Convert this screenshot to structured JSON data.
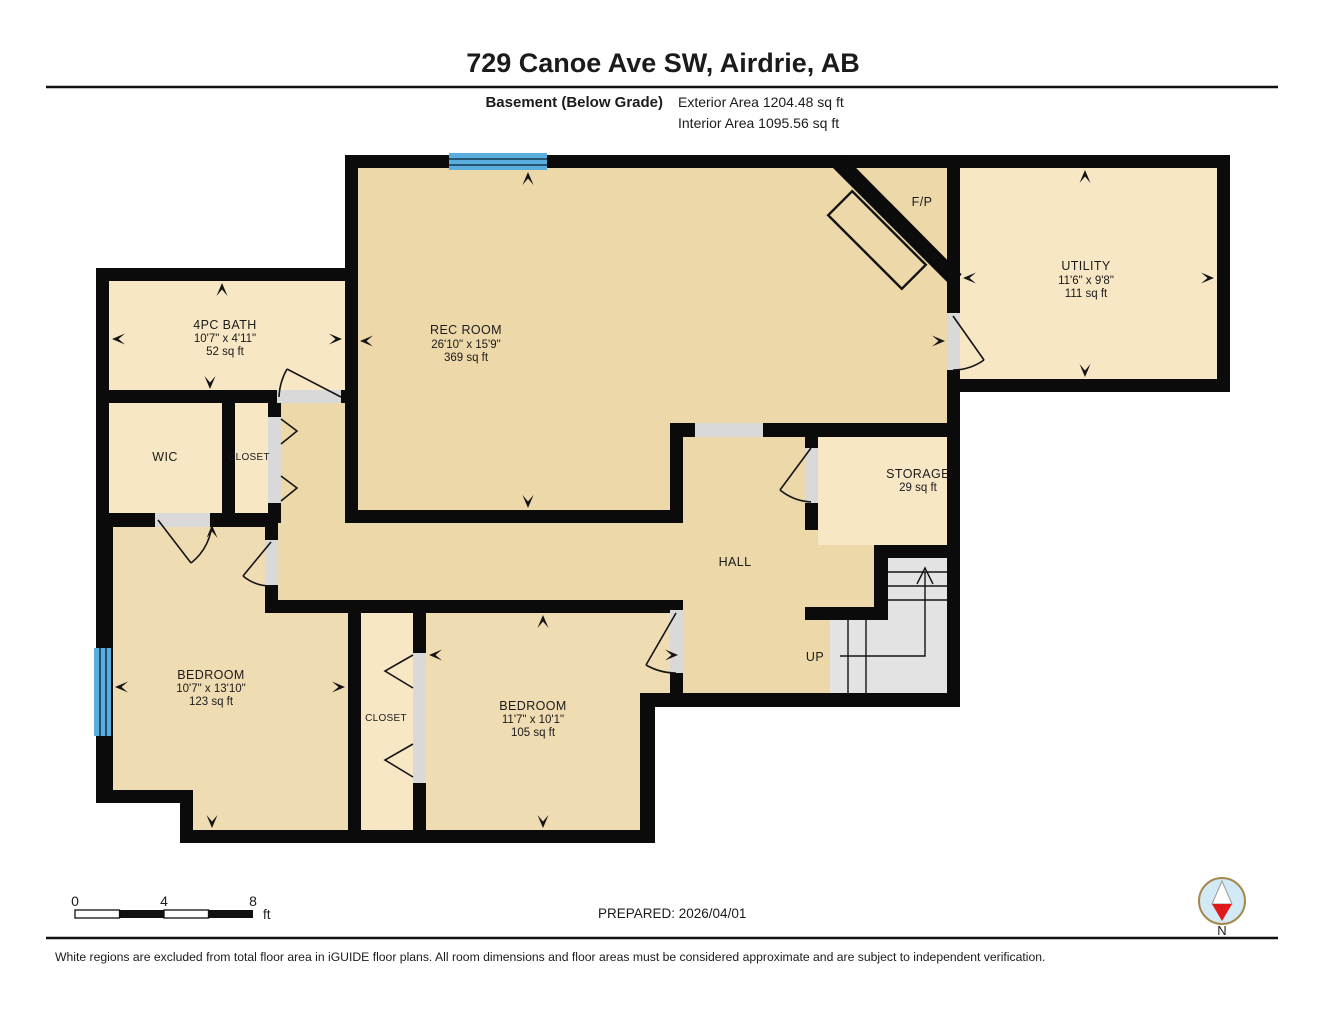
{
  "header": {
    "title": "729 Canoe Ave SW, Airdrie, AB",
    "floor_label": "Basement (Below Grade)",
    "exterior_area": "Exterior Area 1204.48 sq ft",
    "interior_area": "Interior Area 1095.56 sq ft"
  },
  "rooms": {
    "rec": {
      "name": "REC ROOM",
      "dims": "26'10\" x 15'9\"",
      "area": "369 sq ft"
    },
    "utility": {
      "name": "UTILITY",
      "dims": "11'6\" x 9'8\"",
      "area": "111 sq ft"
    },
    "bath": {
      "name": "4PC BATH",
      "dims": "10'7\" x 4'11\"",
      "area": "52 sq ft"
    },
    "wic": {
      "name": "WIC"
    },
    "closet1": {
      "name": "CLOSET"
    },
    "storage": {
      "name": "STORAGE",
      "area": "29 sq ft"
    },
    "hall": {
      "name": "HALL"
    },
    "stairs": {
      "name": "UP"
    },
    "bedroom1": {
      "name": "BEDROOM",
      "dims": "10'7\" x 13'10\"",
      "area": "123 sq ft"
    },
    "closet2": {
      "name": "CLOSET"
    },
    "bedroom2": {
      "name": "BEDROOM",
      "dims": "11'7\" x 10'1\"",
      "area": "105 sq ft"
    },
    "fireplace": {
      "name": "F/P"
    }
  },
  "scale_bar": {
    "start": "0",
    "mid": "4",
    "end": "8",
    "unit": "ft"
  },
  "compass": {
    "label": "N"
  },
  "footer": {
    "prepared": "PREPARED: 2026/04/01",
    "disclaimer": "White regions are excluded from total floor area in iGUIDE floor plans. All room dimensions and floor areas must be considered approximate and are subject to independent verification."
  },
  "colors": {
    "wall": "#0b0b0b",
    "floor_main": "#ecd8a9",
    "floor_light": "#f8e7c4",
    "window": "#5aaede",
    "stairs": "#e3e3e3",
    "compass_red": "#e01a1c"
  }
}
